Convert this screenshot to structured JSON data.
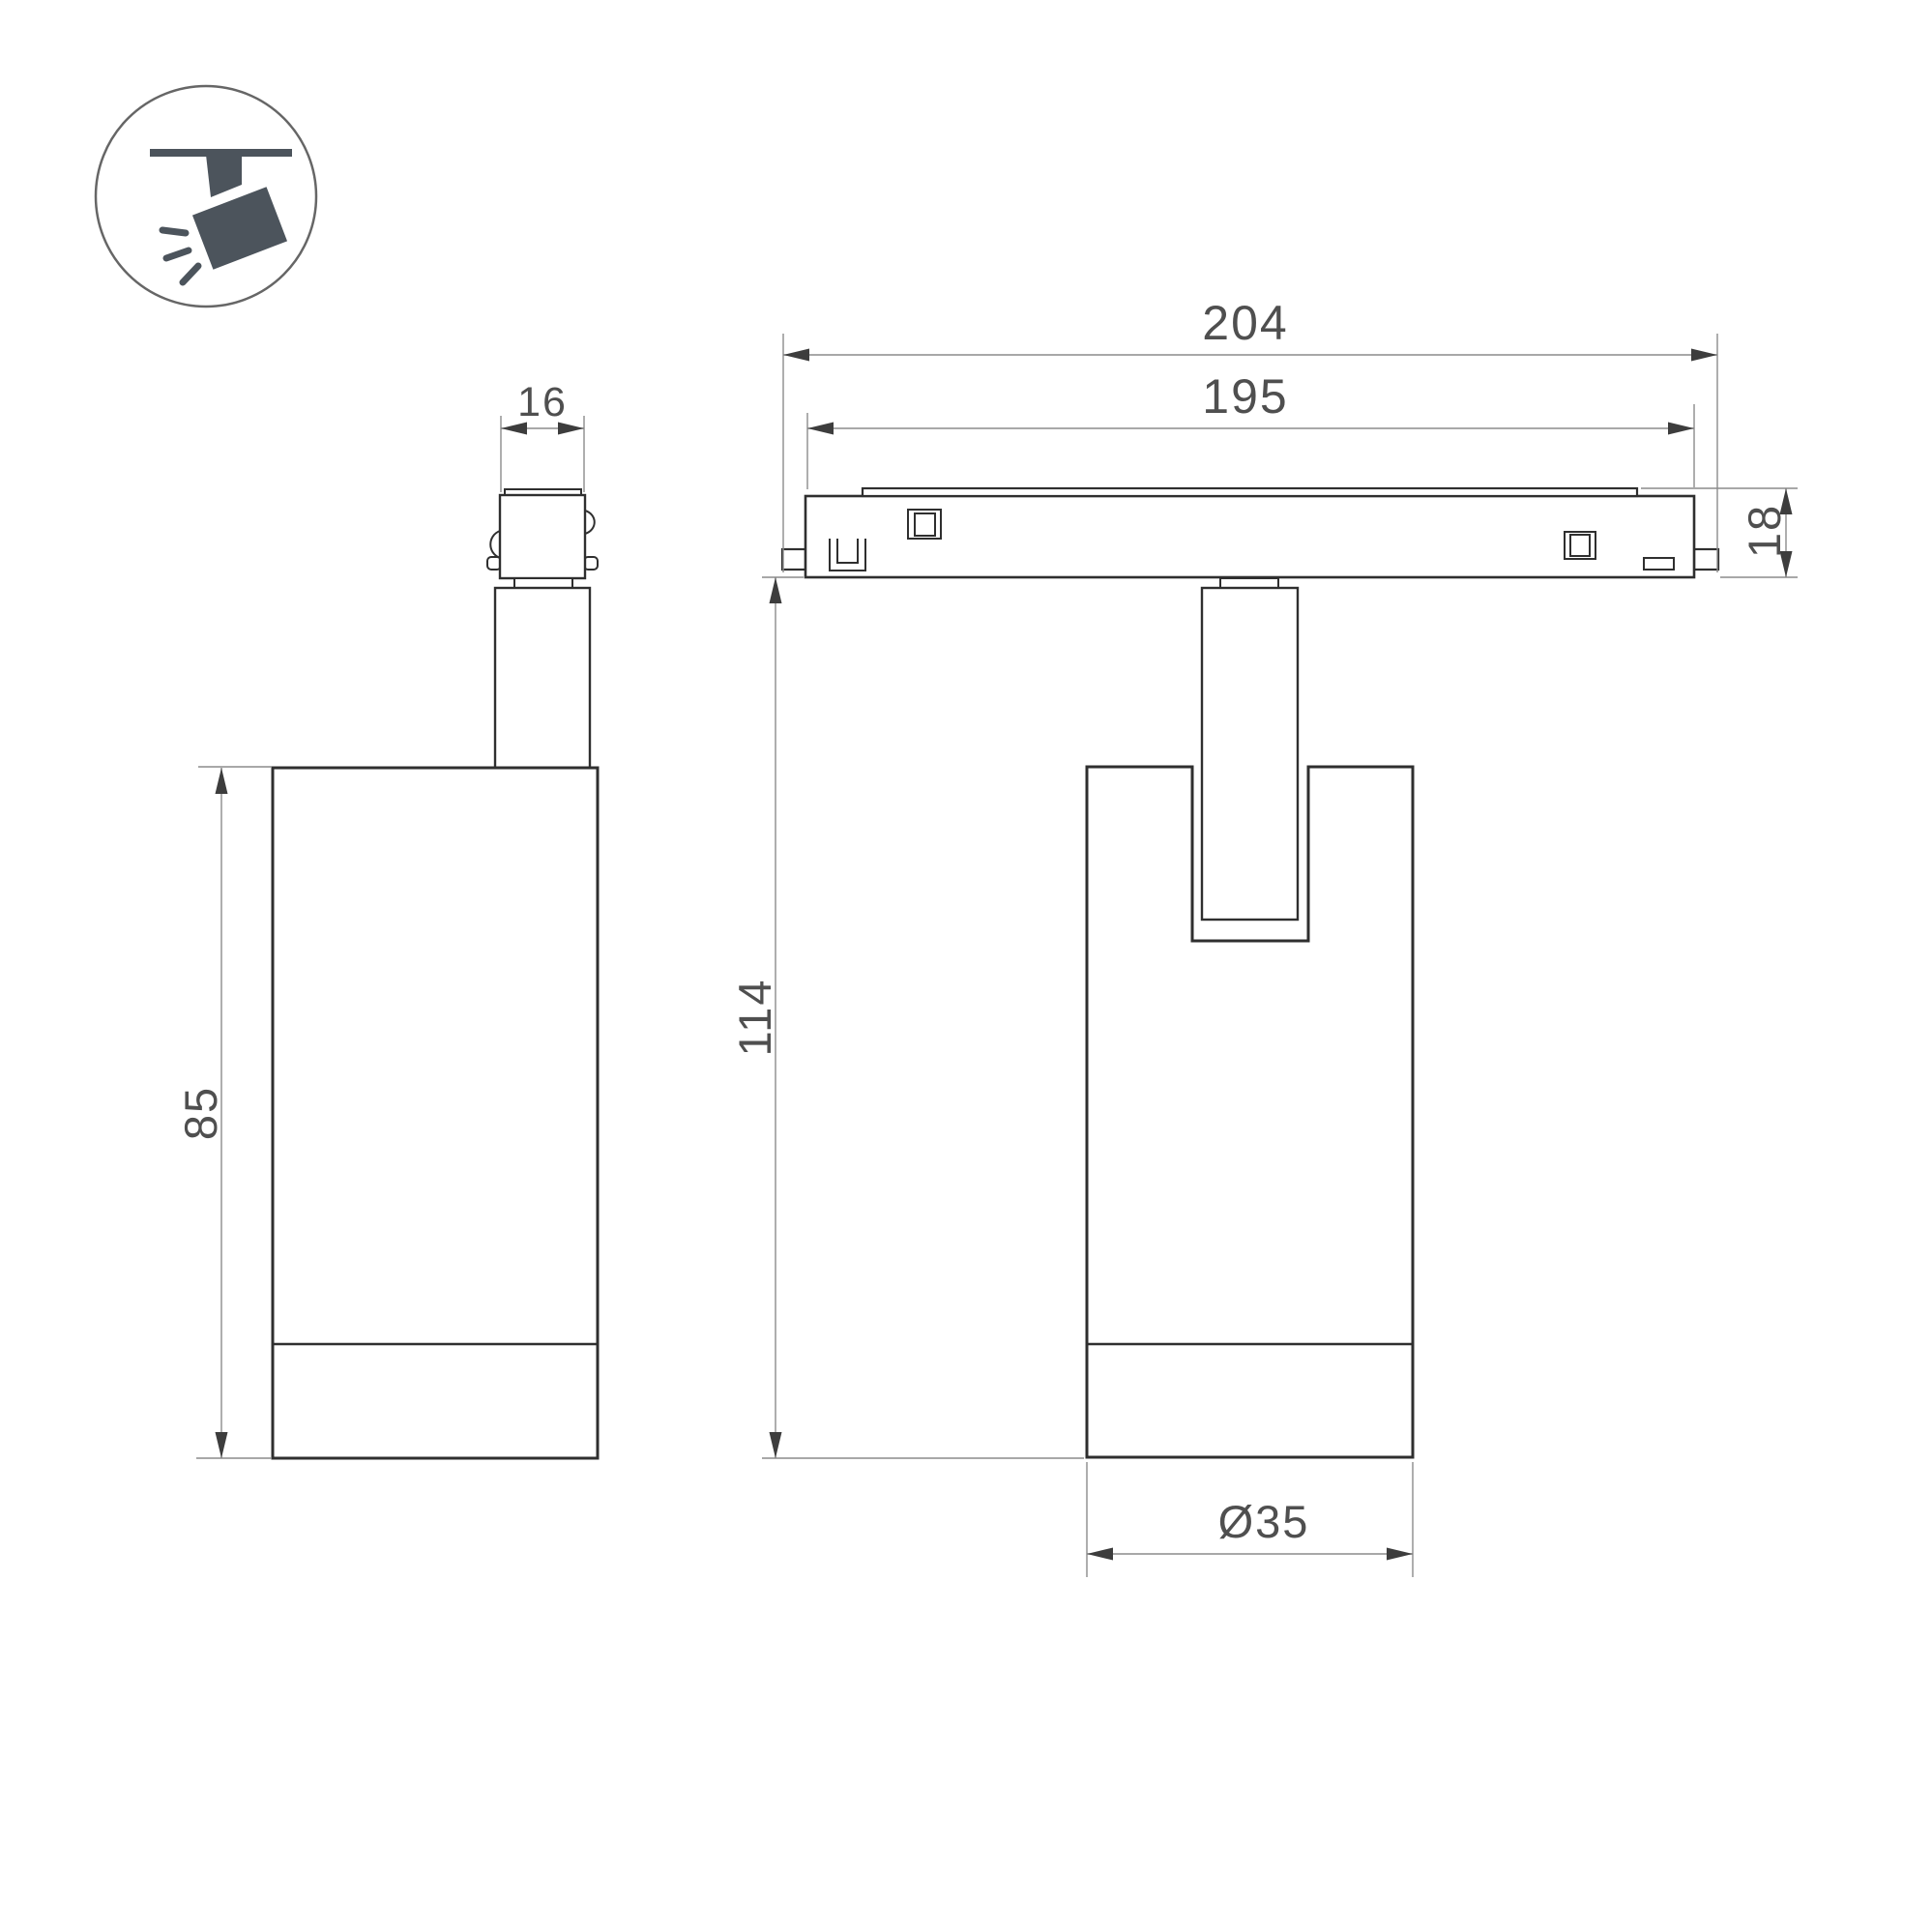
{
  "drawing": {
    "labels": {
      "adapter_width": "16",
      "track_outer_length": "204",
      "track_inner_length": "195",
      "track_height": "18",
      "body_height": "85",
      "total_height": "114",
      "body_diameter": "Ø35"
    }
  },
  "colors": {
    "background": "#ffffff",
    "outline": "#2f2f2f",
    "dim-line": "#8c8c8c",
    "arrow": "#3d3d3d",
    "text": "#4f4f4f",
    "icon-fill": "#4c545c",
    "icon-stroke": "#666666"
  }
}
